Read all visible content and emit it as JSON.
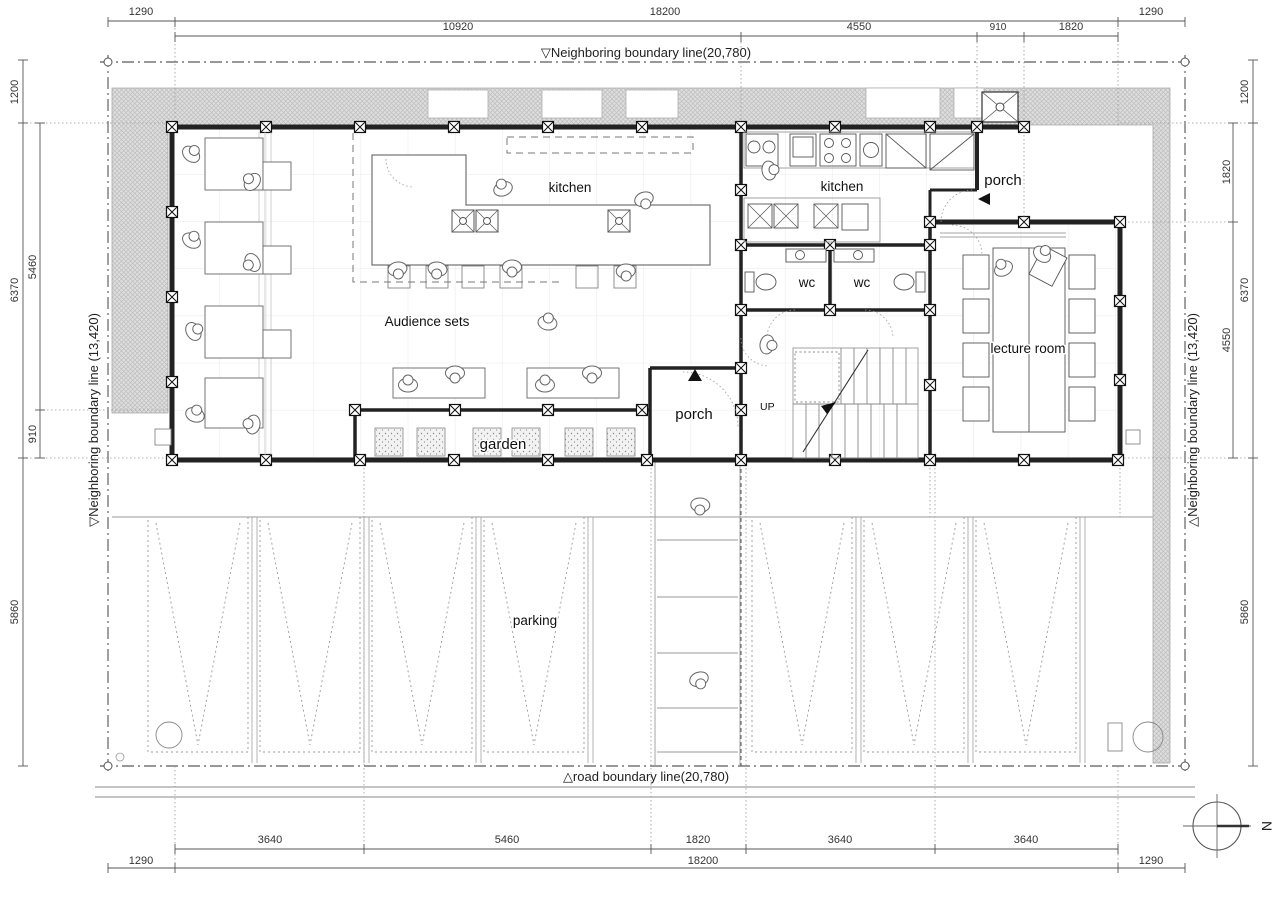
{
  "boundary": {
    "top": "▽Neighboring boundary line(20,780)",
    "bottom": "△road boundary line(20,780)",
    "left": "▽Neighboring boundary line (13,420)",
    "right": "△Neighboring boundary line (13,420)"
  },
  "dims": {
    "top1": [
      "1290",
      "18200",
      "1290"
    ],
    "top2": [
      "10920",
      "4550",
      "910",
      "1820"
    ],
    "left_outer": [
      "1200",
      "6370",
      "5860"
    ],
    "left_inner": [
      "5460",
      "910"
    ],
    "right_outer": [
      "1200",
      "6370",
      "5860"
    ],
    "right_inner": [
      "1820",
      "4550"
    ],
    "bottom1": [
      "3640",
      "5460",
      "1820",
      "3640",
      "3640"
    ],
    "bottom2": [
      "18200"
    ],
    "bottom3": [
      "1290",
      "1290"
    ]
  },
  "rooms": {
    "kitchen_main": "kitchen",
    "kitchen_sub": "kitchen",
    "audience": "Audience sets",
    "wc_left": "wc",
    "wc_right": "wc",
    "lecture": "lecture room",
    "porch_upper": "porch",
    "porch_lower": "porch",
    "garden": "garden",
    "parking": "parking",
    "stairs": "UP"
  },
  "compass": {
    "north": "N"
  },
  "colors": {
    "hatch": "#dedede",
    "wall": "#222222",
    "line": "#555555"
  }
}
